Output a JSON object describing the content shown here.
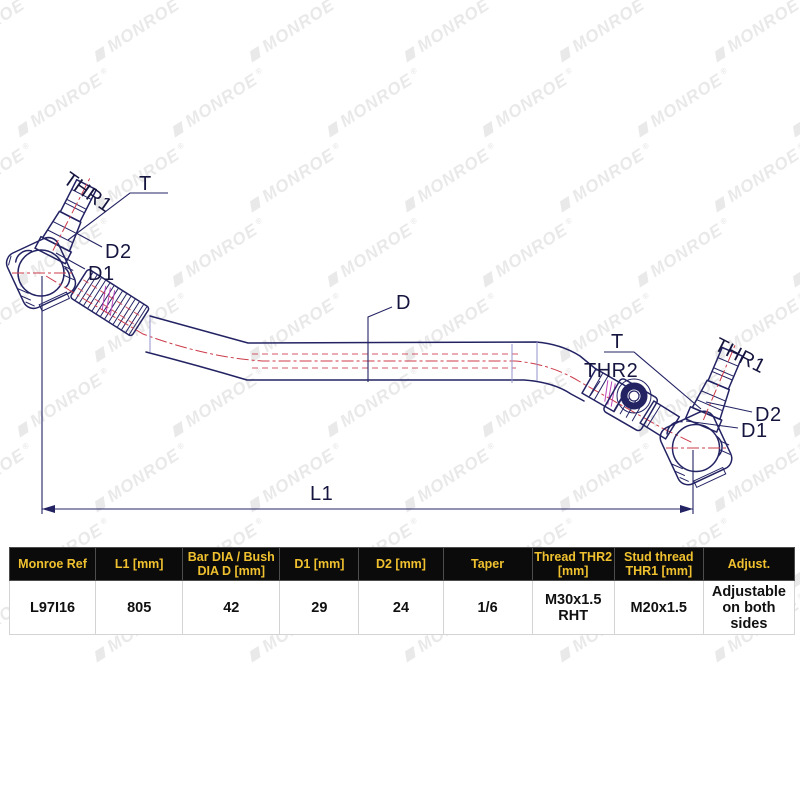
{
  "watermark": {
    "text": "MONROE"
  },
  "drawing": {
    "labels": {
      "left_thr1": "THR1",
      "left_t": "T",
      "left_d2": "D2",
      "left_d1": "D1",
      "bar_d": "D",
      "length": "L1",
      "right_t": "T",
      "right_thr2": "THR2",
      "right_thr1": "THR1",
      "right_d2": "D2",
      "right_d1": "D1"
    },
    "colors": {
      "outline": "#232364",
      "centerline": "#cc3b4a",
      "construction": "#bb44bb",
      "label": "#15153f",
      "watermark": "#e9e9e9"
    }
  },
  "table": {
    "header_bg": "#0b0b0b",
    "header_color": "#f0c12f",
    "headers": [
      "Monroe Ref",
      "L1 [mm]",
      "Bar DIA / Bush\nDIA D [mm]",
      "D1 [mm]",
      "D2 [mm]",
      "Taper",
      "Thread THR2\n[mm]",
      "Stud thread\nTHR1 [mm]",
      "Adjust."
    ],
    "row": [
      "L97I16",
      "805",
      "42",
      "29",
      "24",
      "1/6",
      "M30x1.5\nRHT",
      "M20x1.5",
      "Adjustable\non both\nsides"
    ]
  }
}
